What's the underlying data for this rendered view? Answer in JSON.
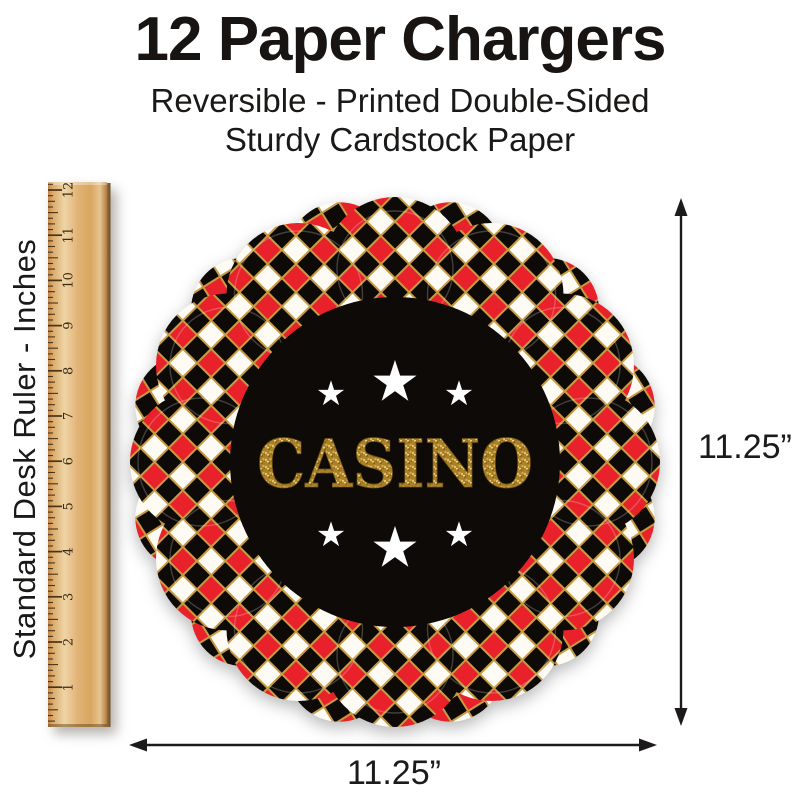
{
  "header": {
    "title": "12 Paper Chargers",
    "subtitle_line1": "Reversible - Printed Double-Sided",
    "subtitle_line2": "Sturdy Cardstock Paper"
  },
  "ruler": {
    "label": "Standard Desk Ruler - Inches",
    "numbers": [
      "1",
      "2",
      "3",
      "4",
      "5",
      "6",
      "7",
      "8",
      "9",
      "10",
      "11",
      "12"
    ]
  },
  "plate": {
    "label": "CASINO",
    "star_icon": "★",
    "colors": {
      "red": "#e8212b",
      "black": "#0d0a07",
      "white": "#fdfbf4",
      "gold_trim": "#c79b43",
      "gold_text": "#b68a2c"
    }
  },
  "dimensions": {
    "height_label": "11.25”",
    "width_label": "11.25”"
  },
  "scene": {
    "background": "#ffffff",
    "wood_color": "#dcab69",
    "arrow_color": "#1d1b1a"
  }
}
